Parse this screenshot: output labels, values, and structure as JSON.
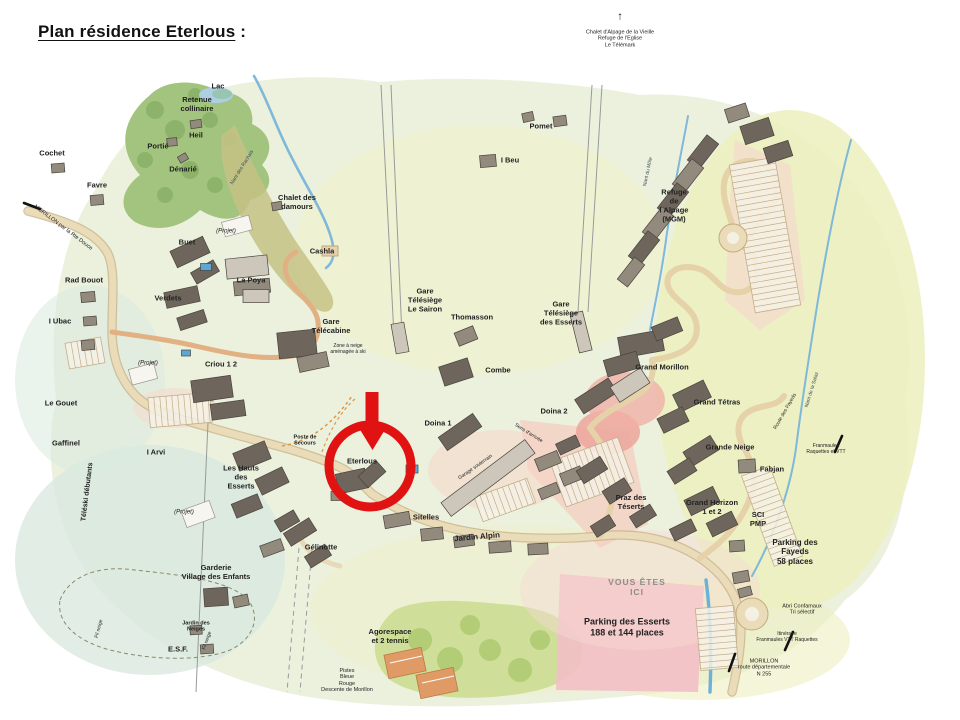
{
  "page": {
    "title": "Plan résidence Eterlous",
    "title_suffix": " :"
  },
  "colors": {
    "highlight_red": "#e01212",
    "map_green": "#ecf1de",
    "road_tan": "#eadbb9",
    "village_road_orange": "#e2b183",
    "river_blue": "#7fb8d8",
    "building_dark": "#6e665c",
    "parking_pink": "#f2bfc6",
    "forest_green": "#a3c47f"
  },
  "map": {
    "highlight": {
      "target": "Eterlous",
      "circle_x": 370,
      "circle_y": 466,
      "circle_r": 41,
      "arrow_x": 372,
      "arrow_y": 392,
      "color": "#e01212"
    },
    "labels": [
      {
        "t": "Lac",
        "x": 218,
        "y": 87
      },
      {
        "t": "Retenue\ncollinaire",
        "x": 197,
        "y": 105
      },
      {
        "t": "Heil",
        "x": 196,
        "y": 136
      },
      {
        "t": "Portié",
        "x": 158,
        "y": 147
      },
      {
        "t": "Dénarié",
        "x": 183,
        "y": 170
      },
      {
        "t": "Cochet",
        "x": 52,
        "y": 154
      },
      {
        "t": "Favre",
        "x": 97,
        "y": 186
      },
      {
        "t": "Chalet des\ndamours",
        "x": 297,
        "y": 203
      },
      {
        "t": "Cashla",
        "x": 322,
        "y": 252
      },
      {
        "t": "La Poya",
        "x": 251,
        "y": 281
      },
      {
        "t": "Gare\nTélécabine",
        "x": 331,
        "y": 327
      },
      {
        "t": "Gare\nTélésiège\nLe Sairon",
        "x": 425,
        "y": 301
      },
      {
        "t": "Thomasson",
        "x": 472,
        "y": 318
      },
      {
        "t": "Buet",
        "x": 187,
        "y": 243
      },
      {
        "t": "Rad Bouot",
        "x": 84,
        "y": 281
      },
      {
        "t": "Verdets",
        "x": 168,
        "y": 299
      },
      {
        "t": "I Ubac",
        "x": 60,
        "y": 322
      },
      {
        "t": "Criou 1 2",
        "x": 221,
        "y": 365
      },
      {
        "t": "Le Gouet",
        "x": 61,
        "y": 404
      },
      {
        "t": "Gaffinel",
        "x": 66,
        "y": 444
      },
      {
        "t": "I Arvi",
        "x": 156,
        "y": 453
      },
      {
        "t": "Les Hauts\ndes\nEsserts",
        "x": 241,
        "y": 478
      },
      {
        "t": "Garderie\nVillage des Enfants",
        "x": 216,
        "y": 573
      },
      {
        "t": "E.S.F.",
        "x": 178,
        "y": 650
      },
      {
        "t": "Agorespace\net 2 tennis",
        "x": 390,
        "y": 637
      },
      {
        "t": "Gélinotte",
        "x": 321,
        "y": 548
      },
      {
        "t": "Sitelles",
        "x": 426,
        "y": 518
      },
      {
        "t": "Eterlous",
        "x": 362,
        "y": 462,
        "n": "label-eterlous"
      },
      {
        "t": "Doina 1",
        "x": 438,
        "y": 424
      },
      {
        "t": "Doina 2",
        "x": 554,
        "y": 412
      },
      {
        "t": "Combe",
        "x": 498,
        "y": 371
      },
      {
        "t": "Praz des\nTéserts",
        "x": 631,
        "y": 503
      },
      {
        "t": "Grand Morillon",
        "x": 662,
        "y": 368
      },
      {
        "t": "Gare\nTélésiège\ndes Esserts",
        "x": 561,
        "y": 314
      },
      {
        "t": "Grand Tétras",
        "x": 717,
        "y": 403
      },
      {
        "t": "Grande Neige",
        "x": 730,
        "y": 448
      },
      {
        "t": "Fabjan",
        "x": 772,
        "y": 470
      },
      {
        "t": "Grand Horizon\n1 et 2",
        "x": 712,
        "y": 508
      },
      {
        "t": "SCI\nPMP",
        "x": 758,
        "y": 520
      },
      {
        "t": "Refuge\nde\nl Alpage\n(MGM)",
        "x": 674,
        "y": 206
      },
      {
        "t": "Pomet",
        "x": 541,
        "y": 127
      },
      {
        "t": "I Beu",
        "x": 510,
        "y": 161
      },
      {
        "t": "Parking des Esserts\n188 et 144 places",
        "x": 627,
        "y": 627,
        "s": 9
      },
      {
        "t": "Parking des\nFayeds\n58 places",
        "x": 795,
        "y": 552,
        "s": 8
      },
      {
        "t": "Jardin Alpin",
        "x": 477,
        "y": 537,
        "r": -5,
        "s": 8
      },
      {
        "t": "VOUS ÊTES\nICI",
        "x": 637,
        "y": 587,
        "s": 8.5,
        "c": "#8a8f8a",
        "ls": 1,
        "n": "label-vous-etes-ici"
      },
      {
        "t": "Poste de\nSecours",
        "x": 305,
        "y": 441,
        "s": 5.5
      },
      {
        "t": "Jardin des\nNeiges",
        "x": 196,
        "y": 627,
        "s": 5.5
      },
      {
        "t": "Pistes\nBleue\nRouge\nDescente de Morillon",
        "x": 347,
        "y": 681,
        "s": 5.5,
        "b": false
      },
      {
        "t": "Chalet d'Alpage de la Vieille\nRefuge de l'Eglise\nLe Télémark",
        "x": 620,
        "y": 39,
        "s": 5.5,
        "b": false
      },
      {
        "t": "↑",
        "x": 620,
        "y": 17,
        "s": 11,
        "n": "up-arrow-glyph"
      },
      {
        "t": "Abri Confamaux\nTri sélectif",
        "x": 802,
        "y": 610,
        "s": 5.5,
        "b": false
      },
      {
        "t": "Itinéraire\nFranmaules VTT Raquettes",
        "x": 787,
        "y": 638,
        "s": 5,
        "b": false
      },
      {
        "t": "MORILLON\nroute départementale\nN 255",
        "x": 764,
        "y": 668,
        "s": 5.5,
        "b": false
      },
      {
        "t": "Franmaules\nRaquettes et VTT",
        "x": 826,
        "y": 450,
        "s": 5,
        "b": false
      },
      {
        "t": "Zone à neige\naménagée à ski",
        "x": 348,
        "y": 350,
        "s": 5,
        "b": false
      },
      {
        "t": "(Projet)",
        "x": 226,
        "y": 232,
        "s": 6,
        "i": true
      },
      {
        "t": "(Projet)",
        "x": 148,
        "y": 364,
        "s": 6,
        "i": true
      },
      {
        "t": "(Projet)",
        "x": 184,
        "y": 513,
        "s": 6,
        "i": true
      },
      {
        "t": "MORILLON par la Rte Douce",
        "x": 63,
        "y": 228,
        "s": 5.5,
        "r": 37,
        "b": false
      },
      {
        "t": "Téléski débutants",
        "x": 88,
        "y": 492,
        "r": -83,
        "s": 7
      },
      {
        "t": "Fil neige",
        "x": 100,
        "y": 629,
        "r": -75,
        "s": 5,
        "b": false
      },
      {
        "t": "Fil neige",
        "x": 208,
        "y": 641,
        "r": -70,
        "s": 5,
        "b": false
      },
      {
        "t": "Nant des Rachais",
        "x": 243,
        "y": 168,
        "r": -58,
        "s": 5,
        "b": false,
        "c": "#3a4a5a"
      },
      {
        "t": "Nant du Môle",
        "x": 649,
        "y": 172,
        "r": -78,
        "s": 5,
        "b": false,
        "c": "#3a4a5a"
      },
      {
        "t": "Nant de la Salaz",
        "x": 813,
        "y": 390,
        "r": -73,
        "s": 5,
        "b": false,
        "c": "#3a4a5a"
      },
      {
        "t": "Route des Fayeds",
        "x": 786,
        "y": 412,
        "r": -60,
        "s": 5,
        "b": false
      },
      {
        "t": "Sens d'arrivée",
        "x": 528,
        "y": 434,
        "r": 32,
        "s": 5,
        "b": false
      },
      {
        "t": "Garage souterrain",
        "x": 476,
        "y": 468,
        "r": -35,
        "s": 5,
        "b": false
      }
    ]
  }
}
